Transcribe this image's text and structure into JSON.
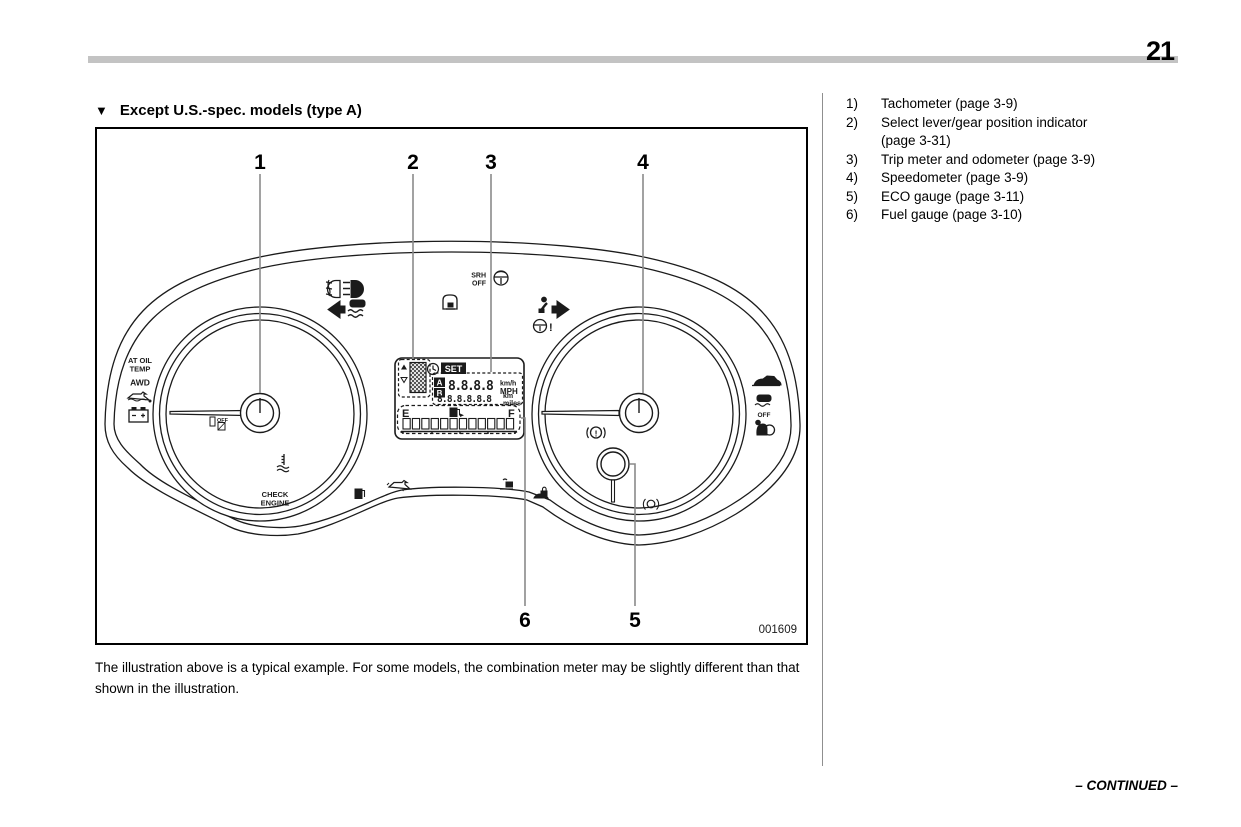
{
  "page": {
    "number": "21",
    "continued": "– CONTINUED –"
  },
  "section": {
    "marker": "▼",
    "title": "Except U.S.-spec. models (type A)"
  },
  "figure": {
    "code": "001609",
    "callouts": {
      "c1": "1",
      "c2": "2",
      "c3": "3",
      "c4": "4",
      "c5": "5",
      "c6": "6"
    },
    "cluster_text": {
      "at_oil": "AT OIL",
      "temp": "TEMP",
      "awd": "AWD",
      "off_indicator": "OFF",
      "check": "CHECK",
      "engine": "ENGINE",
      "srh": "SRH",
      "srh_off": "OFF",
      "vdc_off": "OFF",
      "set": "SET",
      "a": "A",
      "b": "B",
      "e": "E",
      "f": "F",
      "kmh": "km/h",
      "mph": "MPH",
      "km": "km",
      "miles": "miles",
      "digits_top": "8.8.8.8",
      "digits_bottom": "8.8.8.8.8.8",
      "brake_exclaim": "!",
      "steer_exclaim": "!"
    }
  },
  "caption": "The illustration above is a typical example. For some models, the combination meter may be slightly different than that shown in the illustration.",
  "legend": {
    "items": [
      {
        "num": "1)",
        "text": "Tachometer (page 3-9)"
      },
      {
        "num": "2)",
        "text": "Select lever/gear position indicator",
        "line2": "(page 3-31)"
      },
      {
        "num": "3)",
        "text": "Trip meter and odometer (page 3-9)"
      },
      {
        "num": "4)",
        "text": "Speedometer (page 3-9)"
      },
      {
        "num": "5)",
        "text": "ECO gauge (page 3-11)"
      },
      {
        "num": "6)",
        "text": "Fuel gauge (page 3-10)"
      }
    ]
  }
}
